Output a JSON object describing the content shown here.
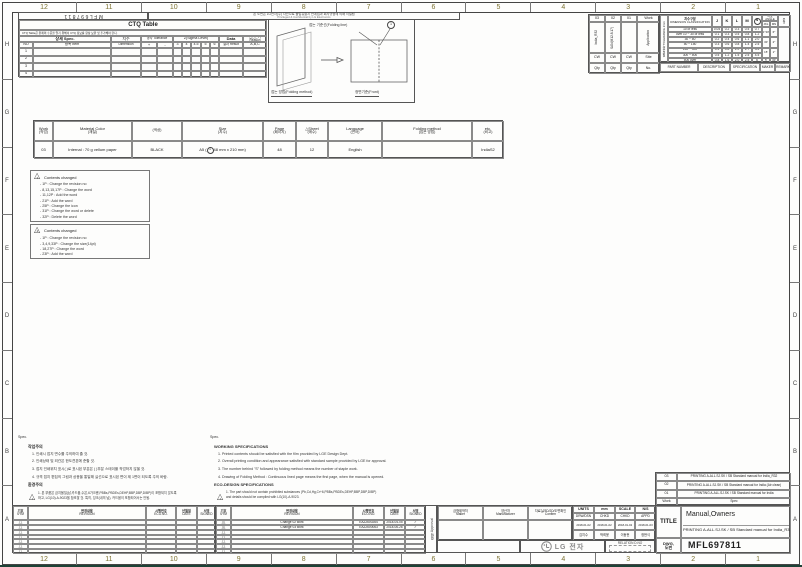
{
  "frame": {
    "doc_no": "MFL697811",
    "confidential_kr": "본 도면은 LG전자(주) 자산으로 불법유출시 관계법과 회사규정에 의해 처벌됨",
    "confidential_en": "Privileged & Confidential by LG Electronics",
    "ruler_numbers": [
      "12",
      "11",
      "10",
      "9",
      "8",
      "7",
      "6",
      "5",
      "4",
      "3",
      "2",
      "1"
    ],
    "row_letters": [
      "H",
      "G",
      "F",
      "E",
      "D",
      "C",
      "B",
      "A"
    ]
  },
  "ctq": {
    "title": "CTQ Table",
    "note": "CTQ Table은 완제의 수준을 알기 위해서 CTQ 정보를 항상 보완 및 추가해야 한다.",
    "spec": "상세 Spec.",
    "no": "NO",
    "item": "항목 Item",
    "dim_kr": "치수",
    "dim_en": "Dimension",
    "tol": "공차 Tolerance",
    "plus": "+",
    "minus": "-",
    "sigma": "Z(Sigma Level)",
    "sigma_cols": [
      "3",
      "4",
      "4.5",
      "5",
      "6"
    ],
    "data": "Data",
    "result": "결과 Result",
    "reason_kr": "판단근거",
    "reason_en": "Reason",
    "reason_abc": "A,B,C",
    "rows": [
      "1",
      "2",
      "3",
      "4"
    ]
  },
  "folding": {
    "line_label": "접는 기준선(Folding line)",
    "mark": "1",
    "method_label": "접는 방법(Folding method)",
    "front_label": "정면기준(Front)"
  },
  "work_table": {
    "header": [
      "03",
      "02",
      "01",
      "Work"
    ],
    "vertical": [
      "India_R32",
      "SAN(M12.8.17)",
      "",
      "Application"
    ],
    "site": [
      "CW",
      "CW",
      "CW",
      "Site"
    ],
    "qty": [
      "Qty",
      "Qty",
      "Qty",
      "No."
    ]
  },
  "part_row": [
    "PART NUMBER",
    "DESCRIPTION",
    "SPECIFICATION",
    "MAKER",
    "REMARK"
  ],
  "tolerance": {
    "side_kr": "일반공차",
    "side_en": "TOLERANCE",
    "side_mm": "2mm",
    "class_kr": "치수구분",
    "class_en": "DIMENSION CLASSIFICATION",
    "cols": [
      "J",
      "K",
      "L",
      "M",
      "N"
    ],
    "angle_kr": "각도",
    "angle_en": "ANGLE",
    "angle_sub": [
      "JKL",
      "MN"
    ],
    "grade": "등급",
    "rows": [
      {
        "range": "10 or less",
        "vals": [
          "0.05",
          "0.2",
          "0.3",
          "0.5",
          "0.7"
        ]
      },
      {
        "range": "over 10 ~ 30 or less",
        "vals": [
          "0.1",
          "0.3",
          "0.5",
          "0.8",
          "1.2"
        ]
      },
      {
        "range": "30 ~ 50",
        "vals": [
          "0.2",
          "0.4",
          "0.6",
          "1.1",
          "2.0"
        ]
      },
      {
        "range": "50 ~ 150",
        "vals": [
          "0.3",
          "0.6",
          "0.8",
          "1.4",
          "2.5"
        ]
      },
      {
        "range": "150 ~ 300",
        "vals": [
          "0.4",
          "0.8",
          "1.0",
          "1.7",
          "3.5"
        ]
      },
      {
        "range": "300 ~ 500",
        "vals": [
          "0.5",
          "1.2",
          "1.5",
          "2.5",
          "4.5"
        ]
      },
      {
        "range": "500 over",
        "vals": [
          "0.8",
          "1.6",
          "2.0",
          "2.5",
          "6"
        ]
      }
    ],
    "angles": [
      [
        "1°30'",
        "6°"
      ],
      [
        "30'",
        "2°"
      ],
      [
        "15'",
        "1°"
      ],
      [
        "5'",
        "30'"
      ]
    ]
  },
  "material": {
    "headers": [
      [
        "Work",
        "(작업)"
      ],
      [
        "Material Color",
        "(재질)"
      ],
      [
        "",
        "(색상)"
      ],
      [
        "Size",
        "(치수)"
      ],
      [
        "Page",
        "(페이지)"
      ],
      [
        "△Sheet",
        "(매수)"
      ],
      [
        "Language",
        "(언어)"
      ],
      [
        "Folding method",
        "(접는 방법)"
      ],
      [
        "etc.",
        "(비고)"
      ]
    ],
    "work": "03",
    "material": "Internal : 70 g vellum paper",
    "color": "BLACK",
    "size_pre": "A5 (",
    "size_mark": "1",
    "size_post": "48 mm x 210 mm)",
    "page": "48",
    "sheet": "12",
    "language": "English",
    "folding": "",
    "etc": "IndiaS2"
  },
  "changes": [
    {
      "sym": "3",
      "title": "Contents changed",
      "items": [
        "1P : Change the revision no",
        "8,13,15,17P : Change the word",
        "11,12P : Add the word",
        "21P : Add the word",
        "25P : Change the icon",
        "31P : Change the word or delete",
        "32P : Delete the word"
      ]
    },
    {
      "sym": "2",
      "title": "Contents changed",
      "items": [
        "1P : Change the revision no",
        "3,4,9,33P : Change the size(14pt)",
        "18,27P : Change the word",
        "23P : Add the word"
      ]
    }
  ],
  "notes_kr": {
    "spec": "Spec.",
    "title": "작업주의",
    "items": [
      "1. 인쇄시 접지 면수를 주의하여 줄 것.",
      "2. 인쇄상태 및 외관은 한도견본에 준할 것.",
      "3. 접지 인쇄위치 표시( )로 표시된 부분은 ( )부분 스테이플 작업하지 않을 것.",
      "4. 규격 접지 편집의 그림과 상응을 통일해 실선으로 표시된 면이 제 1면이 되도록 주의 바람."
    ],
    "eco_title": "환경주의",
    "eco_lines": [
      "1. 본 부품은 금지물질(납,카드뮴,수은,6가크롬,PBBs,PBDEs,DEHP,BBP,DBP,DIBP)이 포함되지 않도록",
      "하고, LG(10)-A-9023을 참조할 것. 특히, 잉크(내의 납), 카드뮴이 포함되어서는 안됨."
    ]
  },
  "notes_en": {
    "spec": "Spec.",
    "title": "WORKING SPECIFICATIONS",
    "items": [
      "1. Printed contents should be satisfied with the film provided by LGE Design Dept.",
      "2. Overall printing condition and appearance satisfied with standard sample provided by LGE for approval.",
      "3. The number behind \"S\" followed by folding method means the number of staple work.",
      "4. Drawing of Folding Method : Continuous lined page means the first page, when the manual is opened."
    ],
    "eco_title": "ECO-DESIGN SPECIFICATIONS",
    "eco_lines": [
      "1. The part should not contain prohibited substances (Pb,Cd,Hg,Cr+6,PBBs,PBDEs,DEHP,BBP,DBP,DIBP)",
      "and details should be complied with LG(10)-A-9023."
    ]
  },
  "rev_strip": {
    "headers": [
      [
        "기호",
        "SYM"
      ],
      [
        "변경내용",
        "REVISION"
      ],
      [
        "시행번호",
        "ECO.NO."
      ],
      [
        "년월일",
        "DATE"
      ],
      [
        "서명",
        "SIGNED"
      ]
    ],
    "right_rows": [
      {
        "sym": "2",
        "rev": "Change 02 work",
        "eco": "EAZ2600264",
        "date": "2018-04-05",
        "signed": "✓"
      },
      {
        "sym": "3",
        "rev": "Change 03 work",
        "eco": "EAZ2600063",
        "date": "2018-06-26",
        "signed": "✓"
      }
    ],
    "row_count": 7
  },
  "approval": {
    "kr": "결재",
    "en": "Approval"
  },
  "maker_block": [
    [
      "금형제작처",
      "Maker"
    ],
    [
      "양산처",
      "Manufacturer"
    ],
    [
      "자료실/3D/2D/도면확인",
      "Confirm"
    ]
  ],
  "units": {
    "units_label": "UNITS",
    "units_value": "mm",
    "scale_label": "SCALE",
    "scale_value": "N/S",
    "roles": [
      "DRW/DSN",
      "CHKD",
      "CHKD",
      "APPD"
    ],
    "dates": [
      "2018-01-02",
      "2018-01-02",
      "2018-01-02",
      "2018-01-03"
    ],
    "names": [
      "김지수",
      "박희윤",
      "이동현",
      "정현식"
    ]
  },
  "lg": {
    "brand": "LG 전자",
    "relation": "RELATION D.NO"
  },
  "title_block": {
    "rev_rows": [
      [
        "03",
        "PRINTING A-ALL.SJ.SK / SB Standard manual for India_R32"
      ],
      [
        "02",
        "PRINTING A-ALL.SJ.SK / SB Standard manual for India (Air clean)"
      ],
      [
        "01",
        "PRINTING A-ALL.SJ.SK / SB Standard manual for India"
      ],
      [
        "Work",
        "Spec"
      ]
    ],
    "title_label": "TITLE",
    "title_line1": "Manual,Owners",
    "title_line2": "PRINTING A-ALL.SJ.SK / SB Standard manual for India_R32",
    "dwg_label1": "DWG,",
    "dwg_label2": "도번",
    "dwg_value": "MFL697811"
  }
}
